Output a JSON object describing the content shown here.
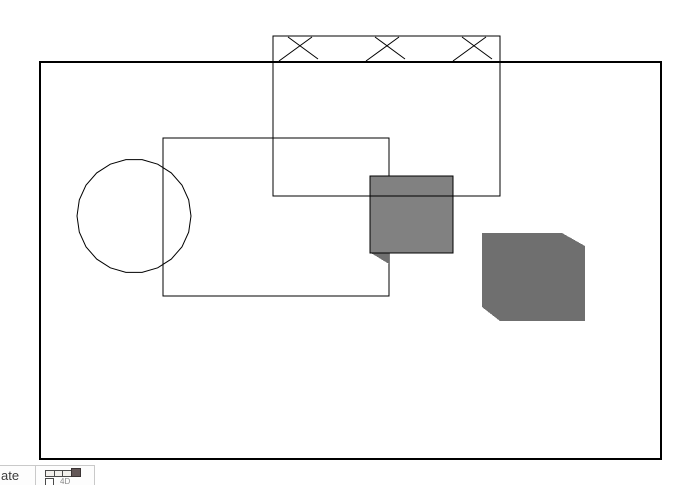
{
  "app": {
    "description": "drawing-canvas-view",
    "background": "#ffffff",
    "line_color": "#000000",
    "fill_gray_light": "#818181",
    "fill_gray_dark": "#6F6F6F"
  },
  "canvas": {
    "width": 686,
    "height": 485,
    "shapes": [
      {
        "id": "page-border-rectangle",
        "type": "rect",
        "x": 40,
        "y": 62,
        "w": 621,
        "h": 397,
        "stroke": "#000000",
        "stroke_width": 2,
        "fill": "none"
      },
      {
        "id": "middle-rectangle",
        "type": "rect",
        "x": 163,
        "y": 138,
        "w": 226,
        "h": 158,
        "stroke": "#000000",
        "stroke_width": 1,
        "fill": "none"
      },
      {
        "id": "faceted-circle",
        "type": "circle",
        "cx": 134,
        "cy": 216,
        "r": 57,
        "segments": 22,
        "stroke": "#000000",
        "stroke_width": 1,
        "fill": "none"
      },
      {
        "id": "shadow-triangle",
        "type": "polygon",
        "points": [
          [
            371,
            253
          ],
          [
            389,
            253
          ],
          [
            389,
            264
          ]
        ],
        "stroke": "none",
        "fill": "#6F6F6F"
      },
      {
        "id": "gray-square",
        "type": "rect",
        "x": 370,
        "y": 176,
        "w": 83,
        "h": 77,
        "stroke": "#000000",
        "stroke_width": 1,
        "fill": "#818181"
      },
      {
        "id": "tall-rectangle",
        "type": "rect",
        "x": 273,
        "y": 36,
        "w": 227,
        "h": 160,
        "stroke": "#000000",
        "stroke_width": 1,
        "fill": "none"
      },
      {
        "id": "cross-braces",
        "type": "x-marks",
        "centers": [
          297,
          384,
          471
        ],
        "top": 37,
        "bottom": 61,
        "stroke": "#000000",
        "stroke_width": 1
      },
      {
        "id": "gray-cube",
        "type": "polygon",
        "points": [
          [
            482,
            233
          ],
          [
            562,
            233
          ],
          [
            585,
            246
          ],
          [
            585,
            321
          ],
          [
            500,
            321
          ],
          [
            482,
            307
          ]
        ],
        "stroke": "none",
        "fill": "#6F6F6F"
      }
    ]
  },
  "taskbar": {
    "label_fragment": "ate",
    "icon": "table-datasheet-icon",
    "icon_text": "4D"
  }
}
